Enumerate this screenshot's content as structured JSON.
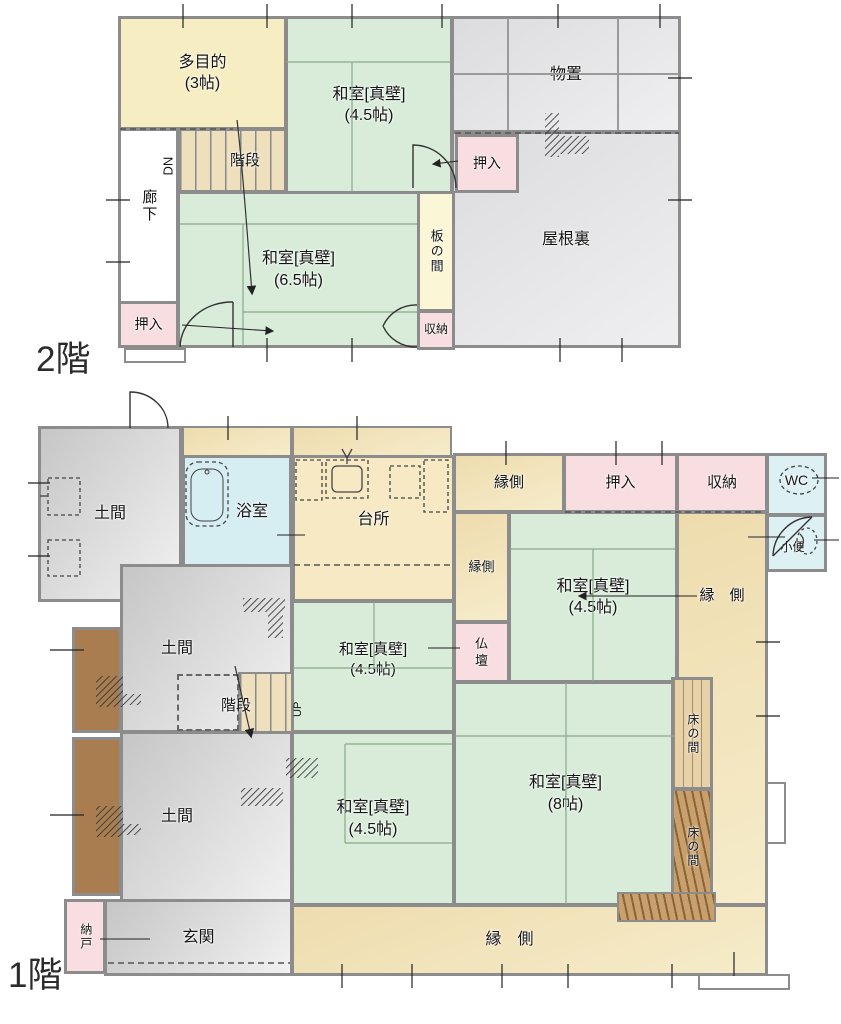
{
  "floor2": {
    "label": "2階",
    "rooms": {
      "multi": "多目的\n(3帖)",
      "washitsu45": "和室[真壁]\n(4.5帖)",
      "monooki": "物置",
      "oshiire_top": "押入",
      "yaneura": "屋根裏",
      "kaidan": "階段",
      "dn": "DN",
      "rouka": "廊下",
      "washitsu65": "和室[真壁]\n(6.5帖)",
      "itanoma": "板の間",
      "oshiire_left": "押入",
      "shunou": "収納"
    }
  },
  "floor1": {
    "label": "1階",
    "rooms": {
      "doma_top": "土間",
      "yokushitsu": "浴室",
      "daidokoro": "台所",
      "engawa_top": "縁側",
      "oshiire": "押入",
      "shunou": "収納",
      "wc": "WC",
      "shouben": "小便",
      "engawa_small": "縁側",
      "washitsu45_ne": "和室[真壁]\n(4.5帖)",
      "butsudan": "仏\n壇",
      "engawa_right": "縁　側",
      "doma_mid": "土間",
      "kaidan": "階段",
      "up": "UP",
      "washitsu45_mid": "和室[真壁]\n(4.5帖)",
      "tokonoma_upper": "床の間",
      "tokonoma_lower": "床の間",
      "washitsu8": "和室[真壁]\n(8帖)",
      "doma_bottom": "土間",
      "washitsu45_sw": "和室[真壁]\n(4.5帖)",
      "nando": "納戸",
      "genkan": "玄関",
      "engawa_bottom": "縁　側"
    }
  },
  "colors": {
    "tatami": "#d8ecd9",
    "closet_pink": "#f8dee1",
    "storage_gray": "#e6e6e8",
    "engawa_tan": "#f2e3b8",
    "bath_blue": "#d6edf2",
    "wood_brown": "#a97d50",
    "wall_gray": "#8c8c8c"
  }
}
